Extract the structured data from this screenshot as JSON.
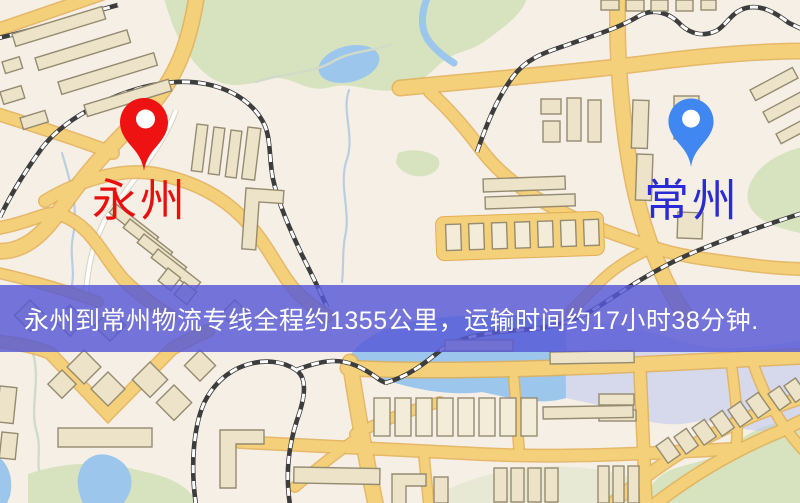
{
  "banner": {
    "text": "永州到常州物流专线全程约1355公里，运输时间约17小时38分钟."
  },
  "labels": {
    "origin": "永州",
    "destination": "常州"
  },
  "route_info": {
    "origin_city": "永州",
    "destination_city": "常州",
    "distance_text": "约1355公里",
    "duration_text": "约17小时38分钟"
  },
  "palette": {
    "banner-bg": "#5658d6d1",
    "banner-text": "#ffffff",
    "map-base": "#f6efe6",
    "park": "#d7e3bf",
    "water": "#9cc6ec",
    "water-wash": "#b9c6ee",
    "stream": "#b9cfdf",
    "road": "#f5d07a",
    "road-casing": "#e2ae54",
    "building": "#ece3c8",
    "building-line": "#958b70",
    "rail-dark": "#3d3d3d",
    "origin-red": "#ee1212",
    "origin-text": "#e8100e",
    "dest-blue": "#4187f2",
    "dest-text": "#2b2bd6"
  }
}
